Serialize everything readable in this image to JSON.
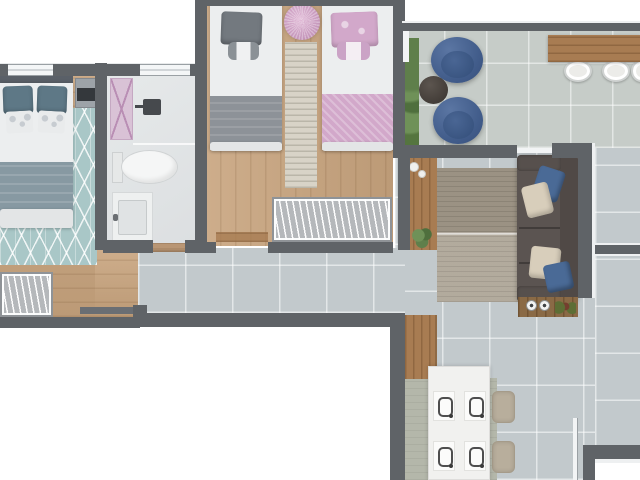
{
  "plan": {
    "type": "apartment-floor-plan-top-view",
    "rooms": [
      {
        "name": "master-bedroom",
        "items": [
          "double-bed",
          "teal-diamond-rug",
          "wardrobe",
          "nightstand-tv",
          "wall-ledge"
        ]
      },
      {
        "name": "bathroom",
        "items": [
          "shower",
          "pink-shower-door",
          "toilet",
          "vanity-sink"
        ]
      },
      {
        "name": "kids-bedroom",
        "items": [
          "single-bed-gray",
          "single-bed-pink",
          "round-pink-pouf",
          "runner-rug",
          "wardrobe"
        ]
      },
      {
        "name": "balcony",
        "items": [
          "planter-strip",
          "bean-bag-chair",
          "bean-bag-chair",
          "round-side-table",
          "bar-counter",
          "stool",
          "stool",
          "stool"
        ]
      },
      {
        "name": "living-room",
        "items": [
          "tv-panel",
          "striated-rug",
          "sofa",
          "throw-pillows",
          "kitchen-counter-cooktop"
        ]
      },
      {
        "name": "dining-area",
        "items": [
          "dining-table",
          "placemats",
          "chair",
          "chair",
          "dining-rug",
          "tall-cabinet"
        ]
      },
      {
        "name": "corridor",
        "items": []
      },
      {
        "name": "side-passage",
        "items": []
      }
    ]
  },
  "palette": {
    "wall": "#5f6367",
    "wood": "#c8a47e",
    "counterWood": "#a87c52",
    "tile": "#c2c9cc",
    "balconyTile": "#c6ccc8",
    "rugTeal": "#a9c7c7",
    "rugRunner": "#d8d3c7",
    "rugLiving": "#a89f90",
    "rugDining": "#b4b7aa",
    "pink": "#d2a8ca",
    "blanketBlue": "#8799a2",
    "sofa": "#5b5451",
    "pillowBlue": "#4a6a96",
    "pillowCream": "#d8cebb",
    "beanBag": "#42608e",
    "table": "#f1f1ef",
    "chair": "#b8ae9c",
    "background": "#ffffff"
  }
}
